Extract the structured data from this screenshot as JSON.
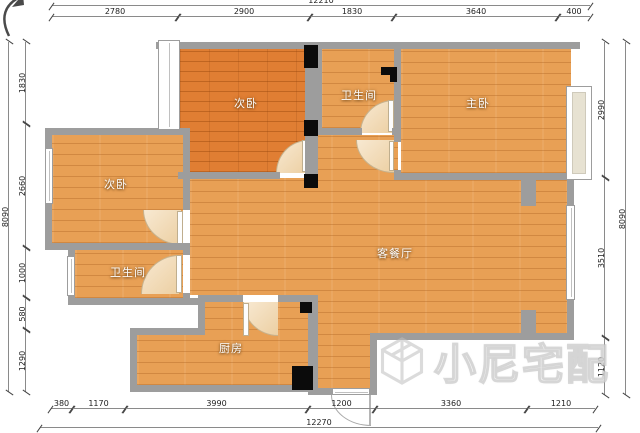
{
  "watermark": {
    "text": "小尼宅配"
  },
  "rooms": {
    "bedroom_top": "次卧",
    "bathroom_top": "卫生间",
    "master_bedroom": "主卧",
    "bedroom_left": "次卧",
    "bathroom_left": "卫生间",
    "living_dining": "客餐厅",
    "kitchen": "厨房"
  },
  "dimensions": {
    "top": {
      "overall": "12210",
      "segments": [
        "2780",
        "2900",
        "1830",
        "3640",
        "400"
      ]
    },
    "bottom": {
      "overall": "12270",
      "segments": [
        "380",
        "1170",
        "3990",
        "1200",
        "3360",
        "1210"
      ]
    },
    "left": {
      "overall": "8090",
      "segments": [
        "1830",
        "2660",
        "1000",
        "580",
        "1290"
      ]
    },
    "right": {
      "overall": "8090",
      "segments": [
        "2990",
        "3510",
        "1120"
      ]
    }
  }
}
